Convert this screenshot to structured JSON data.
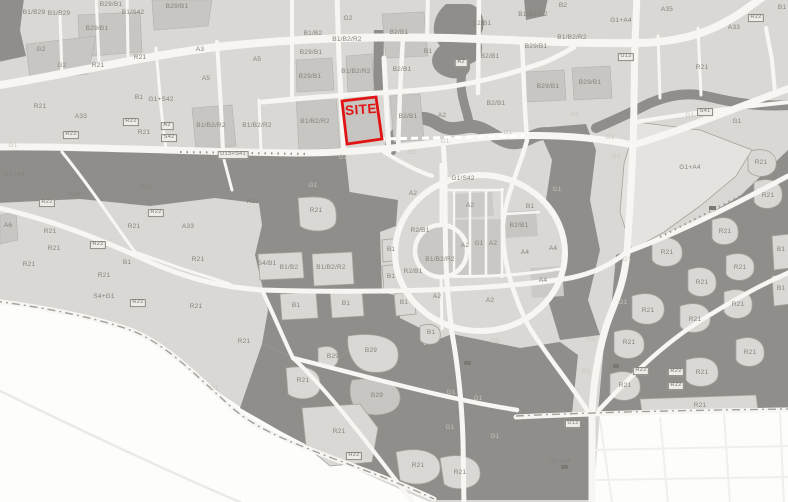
{
  "site": {
    "label": "SITE"
  },
  "colors": {
    "site_red": "#e01414",
    "background": "#fdfdfc",
    "urban_fabric": "#d9d8d4",
    "parcel_mid": "#c7c6c2",
    "green_space_dark": "#8f8e8a",
    "road_white": "#f7f6f2",
    "label_gray": "#84837e"
  },
  "map": {
    "parcel_labels": [
      {
        "t": "B1/B29",
        "x": 34,
        "y": 13
      },
      {
        "t": "B1/B29",
        "x": 59,
        "y": 14
      },
      {
        "t": "B29/B1",
        "x": 111,
        "y": 5
      },
      {
        "t": "B1/S42",
        "x": 133,
        "y": 13
      },
      {
        "t": "B29/B1",
        "x": 97,
        "y": 29
      },
      {
        "t": "B29/B1",
        "x": 177,
        "y": 7
      },
      {
        "t": "G2",
        "x": 348,
        "y": 19
      },
      {
        "t": "B1/B2",
        "x": 313,
        "y": 34
      },
      {
        "t": "B1/B2/R2",
        "x": 347,
        "y": 40
      },
      {
        "t": "B2/B1",
        "x": 399,
        "y": 33
      },
      {
        "t": "B2/B1",
        "x": 482,
        "y": 24
      },
      {
        "t": "B2",
        "x": 563,
        "y": 6
      },
      {
        "t": "B1/B2/R2",
        "x": 533,
        "y": 15
      },
      {
        "t": "G1+A4",
        "x": 621,
        "y": 21
      },
      {
        "t": "A35",
        "x": 667,
        "y": 10
      },
      {
        "t": "A33",
        "x": 734,
        "y": 28
      },
      {
        "t": "R22",
        "x": 756,
        "y": 18,
        "b": 1
      },
      {
        "t": "B1",
        "x": 782,
        "y": 8
      },
      {
        "t": "G2",
        "x": 41,
        "y": 50
      },
      {
        "t": "G2",
        "x": 62,
        "y": 66
      },
      {
        "t": "R21",
        "x": 98,
        "y": 66
      },
      {
        "t": "R21",
        "x": 140,
        "y": 58
      },
      {
        "t": "A3",
        "x": 200,
        "y": 50
      },
      {
        "t": "A5",
        "x": 257,
        "y": 60
      },
      {
        "t": "A5",
        "x": 206,
        "y": 79
      },
      {
        "t": "B29/B1",
        "x": 311,
        "y": 53
      },
      {
        "t": "B29/B1",
        "x": 310,
        "y": 77
      },
      {
        "t": "B1/B2/R2",
        "x": 356,
        "y": 72
      },
      {
        "t": "B2/B1",
        "x": 402,
        "y": 70
      },
      {
        "t": "B1",
        "x": 428,
        "y": 52
      },
      {
        "t": "A2",
        "x": 461,
        "y": 63,
        "b": 1
      },
      {
        "t": "B2/B1",
        "x": 490,
        "y": 57
      },
      {
        "t": "B1/B2/R2",
        "x": 572,
        "y": 38
      },
      {
        "t": "B29/B1",
        "x": 536,
        "y": 47
      },
      {
        "t": "U12",
        "x": 626,
        "y": 57,
        "b": 1
      },
      {
        "t": "B29/B1",
        "x": 548,
        "y": 87
      },
      {
        "t": "B29/B1",
        "x": 590,
        "y": 83
      },
      {
        "t": "R21",
        "x": 702,
        "y": 68
      },
      {
        "t": "R21",
        "x": 40,
        "y": 107
      },
      {
        "t": "A33",
        "x": 81,
        "y": 117
      },
      {
        "t": "R22",
        "x": 71,
        "y": 135,
        "b": 1
      },
      {
        "t": "B1",
        "x": 139,
        "y": 98
      },
      {
        "t": "G1+S42",
        "x": 161,
        "y": 100
      },
      {
        "t": "R22",
        "x": 131,
        "y": 122,
        "b": 1
      },
      {
        "t": "R21",
        "x": 144,
        "y": 133
      },
      {
        "t": "A2",
        "x": 167,
        "y": 126,
        "b": 1
      },
      {
        "t": "S42",
        "x": 169,
        "y": 138,
        "b": 1
      },
      {
        "t": "B1/B2/R2",
        "x": 211,
        "y": 126
      },
      {
        "t": "B1/B2/R2",
        "x": 257,
        "y": 126
      },
      {
        "t": "B1/B2/R2",
        "x": 315,
        "y": 122
      },
      {
        "t": "B2/B1",
        "x": 408,
        "y": 117
      },
      {
        "t": "A2",
        "x": 442,
        "y": 116
      },
      {
        "t": "B2/B1",
        "x": 496,
        "y": 104
      },
      {
        "t": "G1",
        "x": 508,
        "y": 133,
        "d": 1
      },
      {
        "t": "G1",
        "x": 575,
        "y": 115,
        "d": 1
      },
      {
        "t": "G1",
        "x": 610,
        "y": 138,
        "d": 1
      },
      {
        "t": "G1",
        "x": 616,
        "y": 157,
        "d": 1
      },
      {
        "t": "G1",
        "x": 690,
        "y": 116,
        "d": 1
      },
      {
        "t": "S41",
        "x": 705,
        "y": 112,
        "b": 1
      },
      {
        "t": "G1",
        "x": 737,
        "y": 122
      },
      {
        "t": "R21",
        "x": 761,
        "y": 163
      },
      {
        "t": "G1",
        "x": 13,
        "y": 146,
        "d": 1
      },
      {
        "t": "U13+S41",
        "x": 233,
        "y": 155,
        "b": 1
      },
      {
        "t": "G1",
        "x": 343,
        "y": 158,
        "d": 1
      },
      {
        "t": "G1",
        "x": 412,
        "y": 153,
        "d": 1
      },
      {
        "t": "G1",
        "x": 445,
        "y": 142,
        "d": 1
      },
      {
        "t": "G1/S42",
        "x": 463,
        "y": 179
      },
      {
        "t": "A2",
        "x": 413,
        "y": 194
      },
      {
        "t": "G1+A4",
        "x": 14,
        "y": 175
      },
      {
        "t": "G1+A4",
        "x": 690,
        "y": 168
      },
      {
        "t": "G1",
        "x": 557,
        "y": 190,
        "d": 1
      },
      {
        "t": "A33",
        "x": 75,
        "y": 195
      },
      {
        "t": "R22",
        "x": 47,
        "y": 203,
        "b": 1
      },
      {
        "t": "R21",
        "x": 146,
        "y": 188
      },
      {
        "t": "R21",
        "x": 253,
        "y": 202
      },
      {
        "t": "R22",
        "x": 156,
        "y": 213,
        "b": 1
      },
      {
        "t": "A33",
        "x": 188,
        "y": 227
      },
      {
        "t": "A6",
        "x": 8,
        "y": 226
      },
      {
        "t": "R21",
        "x": 50,
        "y": 232
      },
      {
        "t": "R21",
        "x": 54,
        "y": 249
      },
      {
        "t": "R21",
        "x": 29,
        "y": 265
      },
      {
        "t": "R22",
        "x": 98,
        "y": 245,
        "b": 1
      },
      {
        "t": "B1",
        "x": 127,
        "y": 263
      },
      {
        "t": "R21",
        "x": 134,
        "y": 227
      },
      {
        "t": "R21",
        "x": 104,
        "y": 276
      },
      {
        "t": "R21",
        "x": 198,
        "y": 260
      },
      {
        "t": "S4+G1",
        "x": 104,
        "y": 297
      },
      {
        "t": "R22",
        "x": 138,
        "y": 303,
        "b": 1
      },
      {
        "t": "R21",
        "x": 196,
        "y": 307
      },
      {
        "t": "R21",
        "x": 244,
        "y": 342
      },
      {
        "t": "G1",
        "x": 214,
        "y": 389,
        "d": 1
      },
      {
        "t": "G1",
        "x": 313,
        "y": 186,
        "d": 1
      },
      {
        "t": "R21",
        "x": 316,
        "y": 211
      },
      {
        "t": "S4/B1",
        "x": 267,
        "y": 264
      },
      {
        "t": "B1/B2",
        "x": 289,
        "y": 268
      },
      {
        "t": "B1/B2/R2",
        "x": 331,
        "y": 268
      },
      {
        "t": "B1",
        "x": 296,
        "y": 306
      },
      {
        "t": "B1",
        "x": 346,
        "y": 304
      },
      {
        "t": "B1",
        "x": 391,
        "y": 250,
        "d": 0
      },
      {
        "t": "B1",
        "x": 391,
        "y": 277
      },
      {
        "t": "B1",
        "x": 404,
        "y": 303
      },
      {
        "t": "R2/B1",
        "x": 420,
        "y": 231
      },
      {
        "t": "B1/B2/R2",
        "x": 440,
        "y": 260
      },
      {
        "t": "R2/B1",
        "x": 413,
        "y": 272
      },
      {
        "t": "A2",
        "x": 470,
        "y": 206
      },
      {
        "t": "A2",
        "x": 465,
        "y": 246
      },
      {
        "t": "G1",
        "x": 479,
        "y": 244
      },
      {
        "t": "A2",
        "x": 493,
        "y": 244
      },
      {
        "t": "B1",
        "x": 530,
        "y": 207
      },
      {
        "t": "B2/B1",
        "x": 519,
        "y": 226
      },
      {
        "t": "A4",
        "x": 525,
        "y": 253
      },
      {
        "t": "A4",
        "x": 553,
        "y": 249
      },
      {
        "t": "A4",
        "x": 543,
        "y": 281
      },
      {
        "t": "A2",
        "x": 437,
        "y": 297
      },
      {
        "t": "A2",
        "x": 490,
        "y": 301
      },
      {
        "t": "G1",
        "x": 627,
        "y": 260,
        "d": 1
      },
      {
        "t": "G1",
        "x": 623,
        "y": 303,
        "d": 1
      },
      {
        "t": "R21",
        "x": 768,
        "y": 196
      },
      {
        "t": "R21",
        "x": 725,
        "y": 232
      },
      {
        "t": "R21",
        "x": 667,
        "y": 253
      },
      {
        "t": "R21",
        "x": 740,
        "y": 268
      },
      {
        "t": "R21",
        "x": 702,
        "y": 283
      },
      {
        "t": "R21",
        "x": 738,
        "y": 305
      },
      {
        "t": "R21",
        "x": 648,
        "y": 311
      },
      {
        "t": "R21",
        "x": 695,
        "y": 320
      },
      {
        "t": "B1",
        "x": 781,
        "y": 250
      },
      {
        "t": "B1",
        "x": 781,
        "y": 289
      },
      {
        "t": "B1",
        "x": 431,
        "y": 333
      },
      {
        "t": "B29",
        "x": 333,
        "y": 357
      },
      {
        "t": "B29",
        "x": 371,
        "y": 351
      },
      {
        "t": "R21",
        "x": 303,
        "y": 381
      },
      {
        "t": "B29",
        "x": 377,
        "y": 396
      },
      {
        "t": "R21",
        "x": 339,
        "y": 432
      },
      {
        "t": "R22",
        "x": 354,
        "y": 456,
        "b": 1
      },
      {
        "t": "R21",
        "x": 418,
        "y": 466
      },
      {
        "t": "R21",
        "x": 460,
        "y": 473
      },
      {
        "t": "G1",
        "x": 451,
        "y": 393,
        "d": 1
      },
      {
        "t": "G1",
        "x": 450,
        "y": 428,
        "d": 1
      },
      {
        "t": "G1",
        "x": 478,
        "y": 399,
        "d": 1
      },
      {
        "t": "G1",
        "x": 495,
        "y": 437,
        "d": 1
      },
      {
        "t": "G1",
        "x": 495,
        "y": 342,
        "d": 1
      },
      {
        "t": "G1",
        "x": 591,
        "y": 340,
        "d": 1
      },
      {
        "t": "R21",
        "x": 629,
        "y": 343
      },
      {
        "t": "G1",
        "x": 586,
        "y": 372,
        "d": 1
      },
      {
        "t": "R21",
        "x": 625,
        "y": 386
      },
      {
        "t": "R22",
        "x": 641,
        "y": 371,
        "b": 1
      },
      {
        "t": "R22",
        "x": 676,
        "y": 372,
        "b": 1
      },
      {
        "t": "R22",
        "x": 676,
        "y": 386,
        "b": 1
      },
      {
        "t": "R21",
        "x": 702,
        "y": 373
      },
      {
        "t": "R21",
        "x": 750,
        "y": 353
      },
      {
        "t": "R21",
        "x": 700,
        "y": 406
      },
      {
        "t": "U12",
        "x": 573,
        "y": 424,
        "b": 1
      },
      {
        "t": "G1+A4",
        "x": 560,
        "y": 462
      }
    ]
  }
}
